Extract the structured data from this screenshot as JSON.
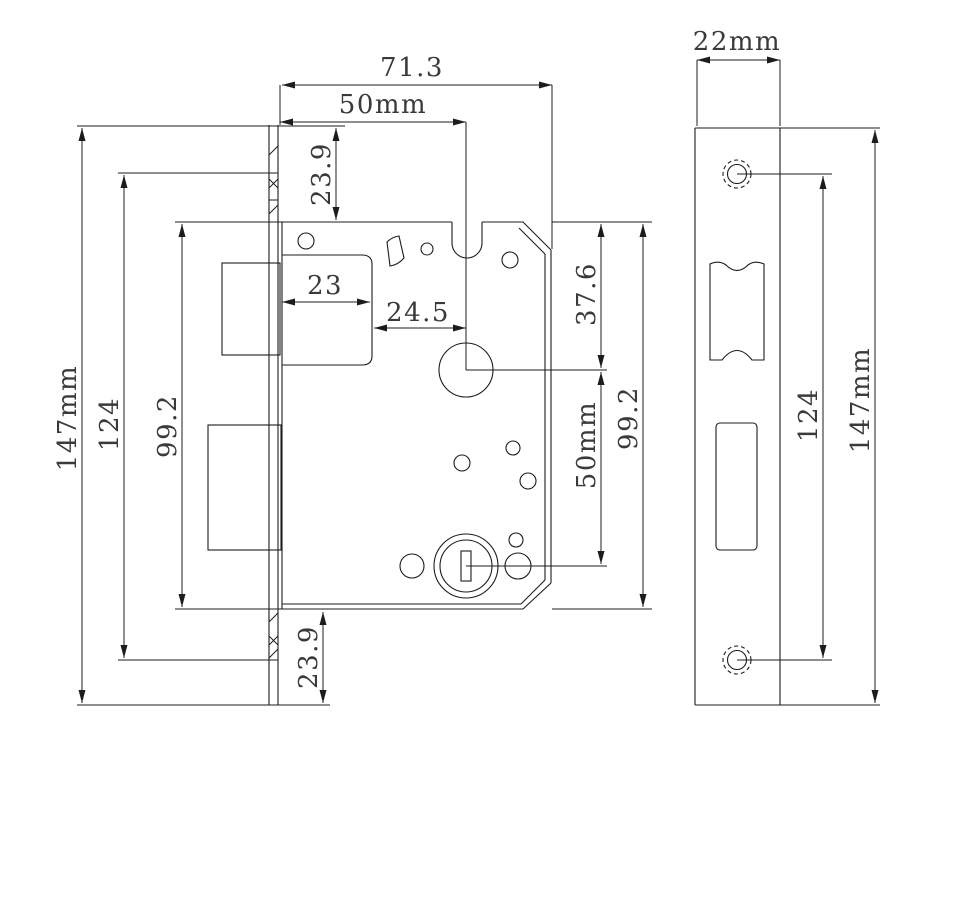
{
  "drawing": {
    "type": "mortise-lock-technical-drawing",
    "colors": {
      "line": "#1c1c1c",
      "text": "#3a3a3a",
      "background": "#ffffff"
    },
    "front_view": {
      "description": "lock body front view",
      "dims": {
        "overall_depth": "71.3",
        "backset": "50mm",
        "top_offset": "23.9",
        "latch_case_width": "23",
        "latch_to_spindle": "24.5",
        "top_to_spindle": "37.6",
        "spindle_to_cylinder": "50mm",
        "body_height_left": "99.2",
        "body_height_right": "99.2",
        "faceplate_height": "147mm",
        "faceplate_inner_height": "124",
        "bottom_offset": "23.9"
      }
    },
    "side_view": {
      "description": "faceplate / strike plate view",
      "dims": {
        "plate_width": "22mm",
        "screw_hole_spacing": "124",
        "plate_height": "147mm"
      }
    }
  }
}
